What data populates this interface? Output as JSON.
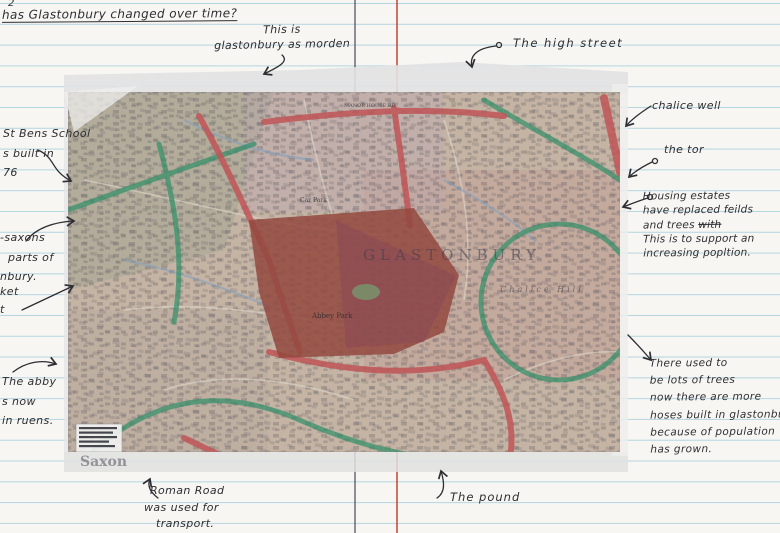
{
  "title": {
    "text": "has Glastonbury changed over time?",
    "page_mark": "2"
  },
  "annotations": {
    "modern": {
      "line1": "This is",
      "line2": "glastonbury as morden"
    },
    "high_street": {
      "text": "The high street"
    },
    "chalice_well": {
      "text": "chalice well"
    },
    "the_tor": {
      "text": "the tor"
    },
    "housing": {
      "line1": "Housing estates",
      "line2": "have replaced feilds",
      "line3": "and trees",
      "line3_struck": "with",
      "line4": "This is to support an",
      "line5": "increasing popltion."
    },
    "st_bens": {
      "line1": "St Bens School",
      "line2": "s built in",
      "line3": "76"
    },
    "saxons": {
      "line1": "-saxons",
      "line2": "parts of",
      "line3": "nbury."
    },
    "fragments": {
      "line1": "ket",
      "line2": "t"
    },
    "abbey": {
      "line1": "The abby",
      "line2": "s now",
      "line3": "in ruens."
    },
    "roman_road": {
      "line1": "Roman Road",
      "line2": "was used for",
      "line3": "transport."
    },
    "pound": {
      "text": "The pound"
    },
    "trees": {
      "line1": "There used to",
      "line2": "be lots of trees",
      "line3": "now there are more",
      "line4": "hoses built in glastonbu",
      "line5": "because of population",
      "line6": "has grown."
    }
  },
  "map": {
    "labels": {
      "town": "GLASTONBURY",
      "hill": "Chalice Hill",
      "park": "Abbey Park",
      "era": "Saxon",
      "road1": "MANOR HOUSE RD",
      "car_park": "Car Park"
    }
  },
  "colors": {
    "rule_blue": "#9ec9dc",
    "margin_red": "#c0392b",
    "ink": "#2d2d33",
    "map_base": "#c6baa9",
    "road_red": "#c05557",
    "road_green": "#2f8f68",
    "abbey_red": "#93493f"
  }
}
